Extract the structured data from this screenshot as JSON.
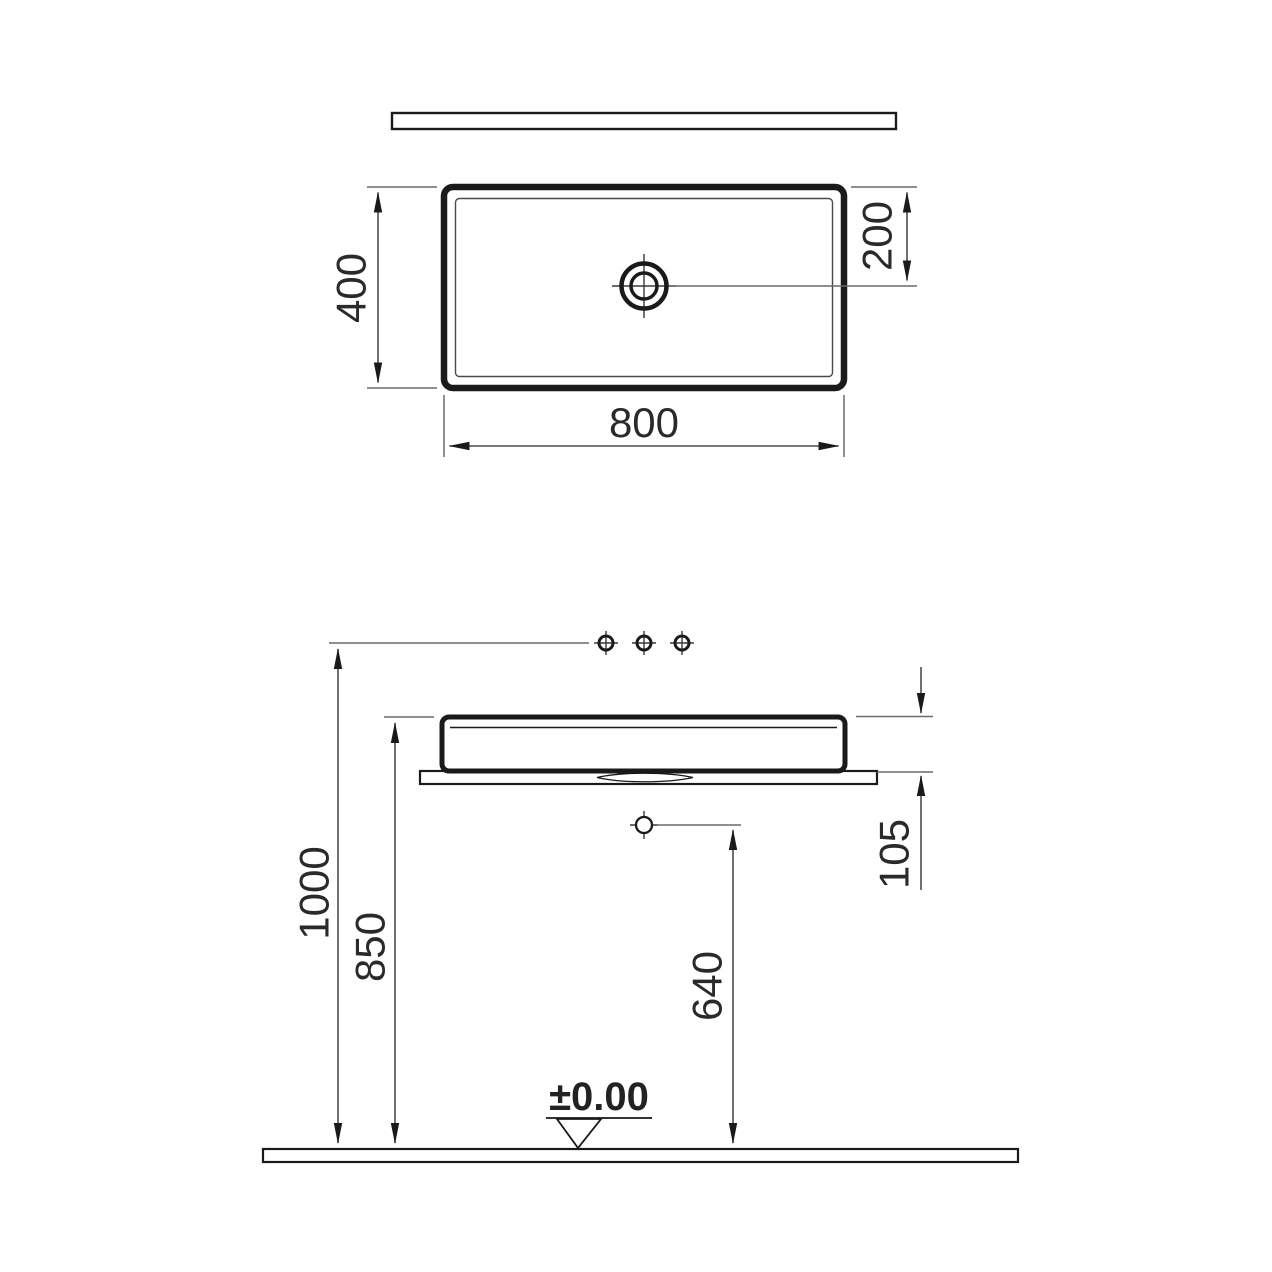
{
  "drawing": {
    "kind": "countertop-washbasin-technical-drawing",
    "colors": {
      "background": "#ffffff",
      "outline": "#1a1a1a",
      "dimension_lines": "#555555",
      "text": "#2a2a2a"
    }
  },
  "plan_view": {
    "dim_width": "800",
    "dim_depth": "400",
    "dim_drain_from_rear": "200"
  },
  "elevation_view": {
    "dim_height_tap_holes": "1000",
    "dim_height_rim": "850",
    "dim_bowl_height": "105",
    "dim_height_drain_outlet": "640",
    "floor_datum": "±0.00"
  }
}
